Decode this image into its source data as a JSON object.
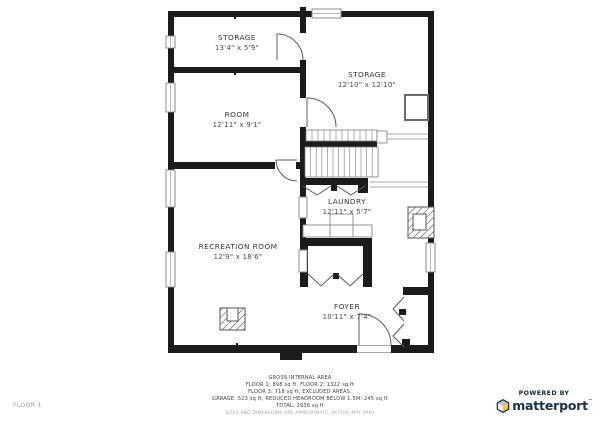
{
  "floor_label": "FLOOR 1",
  "rooms": [
    {
      "name": "STORAGE",
      "dims": "13'4\" x 5'9\""
    },
    {
      "name": "STORAGE",
      "dims": "12'10\" x 12'10\""
    },
    {
      "name": "ROOM",
      "dims": "12'11\" x 9'1\""
    },
    {
      "name": "LAUNDRY",
      "dims": "12'11\" x 5'7\""
    },
    {
      "name": "RECREATION ROOM",
      "dims": "12'9\" x 18'6\""
    },
    {
      "name": "FOYER",
      "dims": "10'11\" x 7'4\""
    }
  ],
  "footer": {
    "title": "GROSS INTERNAL AREA",
    "line1": "FLOOR 1: 898 sq ft, FLOOR 2: 1322 sq ft",
    "line2": "FLOOR 3: 718 sq ft, EXCLUDED AREAS:",
    "line3": "GARAGE: 523 sq ft, REDUCED HEADROOM BELOW 1.5M: 245 sq ft",
    "line4": "TOTAL: 2938 sq ft",
    "disclaimer": "SIZES AND DIMENSIONS ARE APPROXIMATE, ACTUAL MAY VARY"
  },
  "branding": {
    "powered_by": "POWERED BY",
    "brand": "matterport",
    "tm": "™"
  },
  "colors": {
    "wall": "#1b1b1b",
    "brand_navy": "#1e3048",
    "brand_yellow": "#ffc628",
    "hatch": "#555555"
  }
}
